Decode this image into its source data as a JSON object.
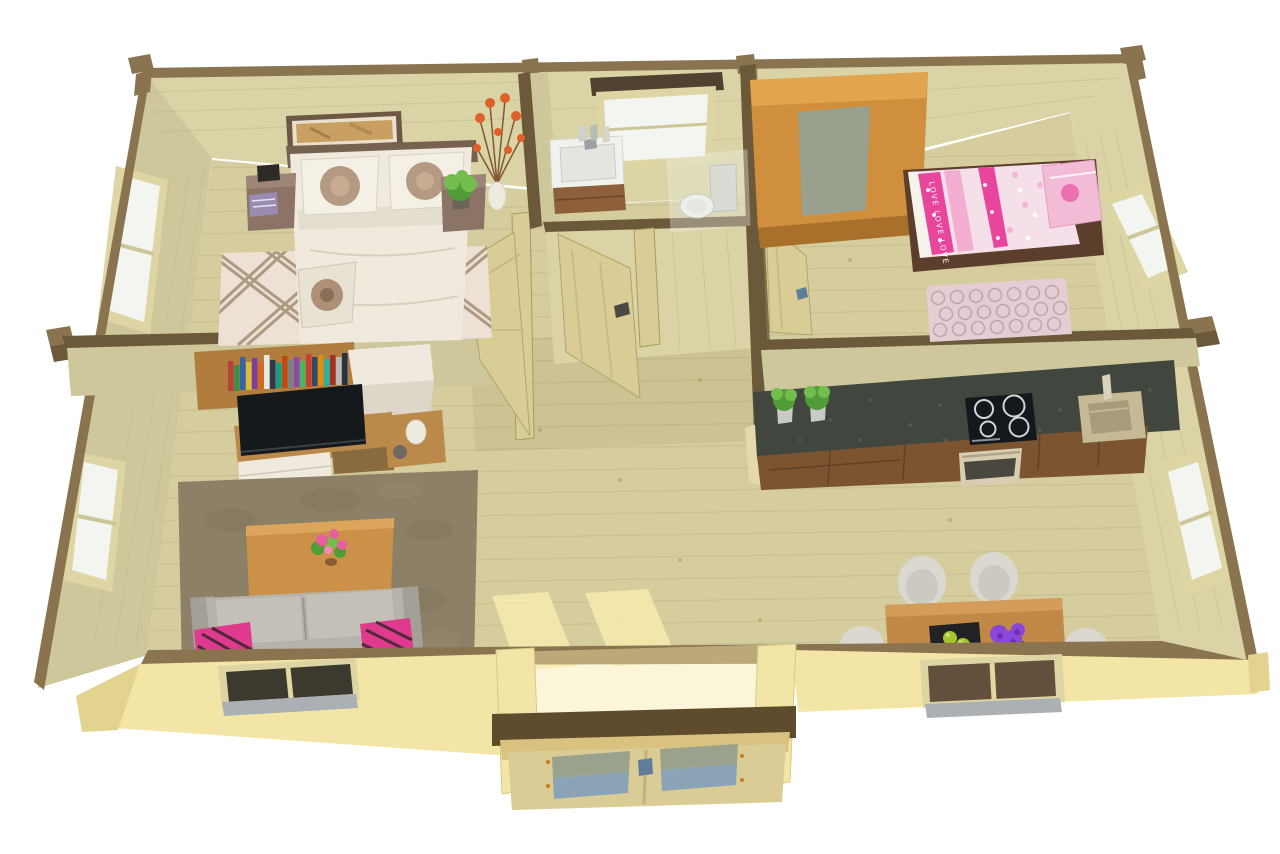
{
  "meta": {
    "description": "3D cutaway (dollhouse) top view render of a one-storey log cabin floor plan on a white background",
    "canvas": {
      "width": 1280,
      "height": 854
    }
  },
  "text": {
    "kid_bed_slogan": "LOVE LOVE LOVE"
  },
  "rooms": {
    "master_bedroom": {
      "name": "Master bedroom",
      "position": "top-left",
      "furniture": [
        "double bed with floral pillows",
        "two brown bedside tables",
        "framed wall picture",
        "potted plant",
        "white vase with orange flowers",
        "beige lattice rug",
        "window"
      ]
    },
    "bathroom": {
      "name": "Bathroom",
      "position": "top-center",
      "furniture": [
        "vanity wash basin",
        "corner toilet with glass screen",
        "small frosted window",
        "open door"
      ]
    },
    "kids_bedroom": {
      "name": "Kids bedroom",
      "position": "top-right",
      "furniture": [
        "oak wardrobe",
        "single bed with pink LOVE bedding",
        "pink patterned rug",
        "window",
        "open door"
      ]
    },
    "living_room": {
      "name": "Living room",
      "position": "bottom-left",
      "furniture": [
        "wall shelf with books",
        "white cabinet",
        "flat TV on wooden sideboard",
        "side table with white lamp",
        "wooden coffee table with pink flowers",
        "grey sofa with two pink cushions",
        "brown shag rug",
        "two windows"
      ]
    },
    "kitchen_dining": {
      "name": "Kitchen and dining area",
      "position": "bottom-right",
      "furniture": [
        "long counter with granite worktop",
        "induction hob",
        "oven",
        "sink",
        "two herb pots",
        "wooden dining table",
        "four white chairs",
        "black dish with green apples",
        "purple flower bouquet",
        "two windows"
      ]
    },
    "hallway": {
      "name": "Hallway",
      "position": "center",
      "features": [
        "open interior doors",
        "sunlight streaks from entrance"
      ]
    },
    "entrance": {
      "name": "Entrance porch",
      "position": "bottom-center",
      "features": [
        "double glazed doors",
        "dark lintel beam"
      ]
    }
  },
  "colors": {
    "background": "#ffffff",
    "floor": "#d5cd9d",
    "floor_line": "#c2ba8c",
    "floor_knot": "#bd8f4a",
    "hall_shade": "#8e865e",
    "wall_face": "#d9d3a6",
    "wall_face_dark": "#cdc79b",
    "wall_line": "#c0b98c",
    "wall_cut_outer": "#8a7450",
    "wall_cut_inner": "#6b5939",
    "wall_sun": "#f2e5a6",
    "wall_sun_dark": "#e3d391",
    "beam_dark": "#5e4c2d",
    "lintel": "#4f4230",
    "window_frame": "#ded5a4",
    "window_glass": "#f2f5f0",
    "window_glass_ext": "#3c3a2e",
    "window_glass_brown": "#63503c",
    "window_sill": "#aab0b4",
    "door_wood": "#d9cc94",
    "door_edge": "#b0a46c",
    "handle": "#5f7d99",
    "picture_frame": "#6d5843",
    "picture_mat": "#e8e0cc",
    "picture_art": "#c99f62",
    "headboard": "#77624f",
    "bed_duvet": "#efeadd",
    "bed_duvet_shade": "#dcd5c4",
    "pillow_flower": "#ad9077",
    "nightstand": "#8b7365",
    "nightstand_top": "#9d8577",
    "magazine": "#9a8bb0",
    "clock": "#2e2a28",
    "plant_green": "#4f9c38",
    "plant_green_light": "#73bd4e",
    "flower_orange": "#e0602a",
    "vase_white": "#efeae0",
    "rug_master": "#ece1d4",
    "rug_master_line": "#a38d73",
    "vanity_white": "#f1f2ed",
    "vanity_cab": "#8d5f3a",
    "toilet_white": "#edefe9",
    "glass_screen": "#eef1ea",
    "wardrobe_top": "#d08f3d",
    "wardrobe_lit": "#e2a54e",
    "wardrobe_front": "#a8702a",
    "wardrobe_panel": "#99a08d",
    "kid_frame": "#5c3e2c",
    "kid_duvet": "#f5dfe9",
    "kid_stripe": "#e8459c",
    "kid_stripe_light": "#f3aed2",
    "kid_pillow": "#f3bcd6",
    "rug_kids": "#e6ccd3",
    "rug_kids_line": "#bda2ac",
    "shelf_wood": "#b07d3e",
    "cabinet_white": "#efe9df",
    "cabinet_white_side": "#ded6c8",
    "tv_black": "#16191b",
    "tv_stand": "#bb8a4a",
    "rug_living": "#8c8066",
    "rug_living_dark": "#7d7258",
    "rug_living_light": "#9a8e72",
    "coffee_table": "#cc9148",
    "coffee_table_light": "#dba55c",
    "sofa": "#b6b3aa",
    "sofa_light": "#c3c0b7",
    "sofa_dark": "#a3a097",
    "cushion_pink": "#df3a8e",
    "cushion_dark": "#2c2824",
    "granite": "#41463f",
    "granite_light": "#6a6f66",
    "kitchen_cab": "#7c5430",
    "cooktop": "#12181c",
    "ring_white": "#cfd6da",
    "oven_front": "#d8cdb0",
    "sink_tan": "#c6b995",
    "sink_basin": "#a89b79",
    "dining_table": "#c18948",
    "dining_table_light": "#d39c58",
    "chair_white": "#dbd8d1",
    "chair_shade": "#c2bfb7",
    "bowl_black": "#222123",
    "apple_green": "#a6c42f",
    "flower_purple": "#8a46d8",
    "flower_purple_dark": "#6e2fb4",
    "flower_pink": "#e85f9f",
    "leaf_green": "#3e5e35",
    "porch_glass_top": "#9aa18c",
    "porch_glass_bottom": "#8ba3b6",
    "porch_header": "#d9c27f",
    "sun_streak": "#f7eaae"
  }
}
